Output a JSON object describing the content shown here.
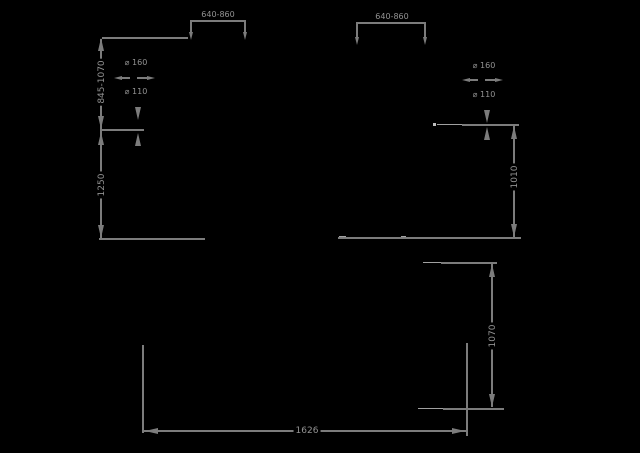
{
  "drawing": {
    "type": "technical-dimension-diagram",
    "colors": {
      "background": "#000000",
      "line": "#7c7c7c",
      "light_line": "#bdbdbd",
      "text": "#929292"
    },
    "labels": {
      "top_left_span": "640-860",
      "top_right_span": "640-860",
      "adjustable_height": "845-1070",
      "overall_height_left": "1250",
      "height_right": "1010",
      "wheel_front_left": "⌀ 160",
      "wheel_rear_left": "⌀ 110",
      "wheel_front_right": "⌀ 160",
      "wheel_rear_right": "⌀ 110",
      "overall_width": "1626",
      "overall_height_front": "1070"
    }
  }
}
